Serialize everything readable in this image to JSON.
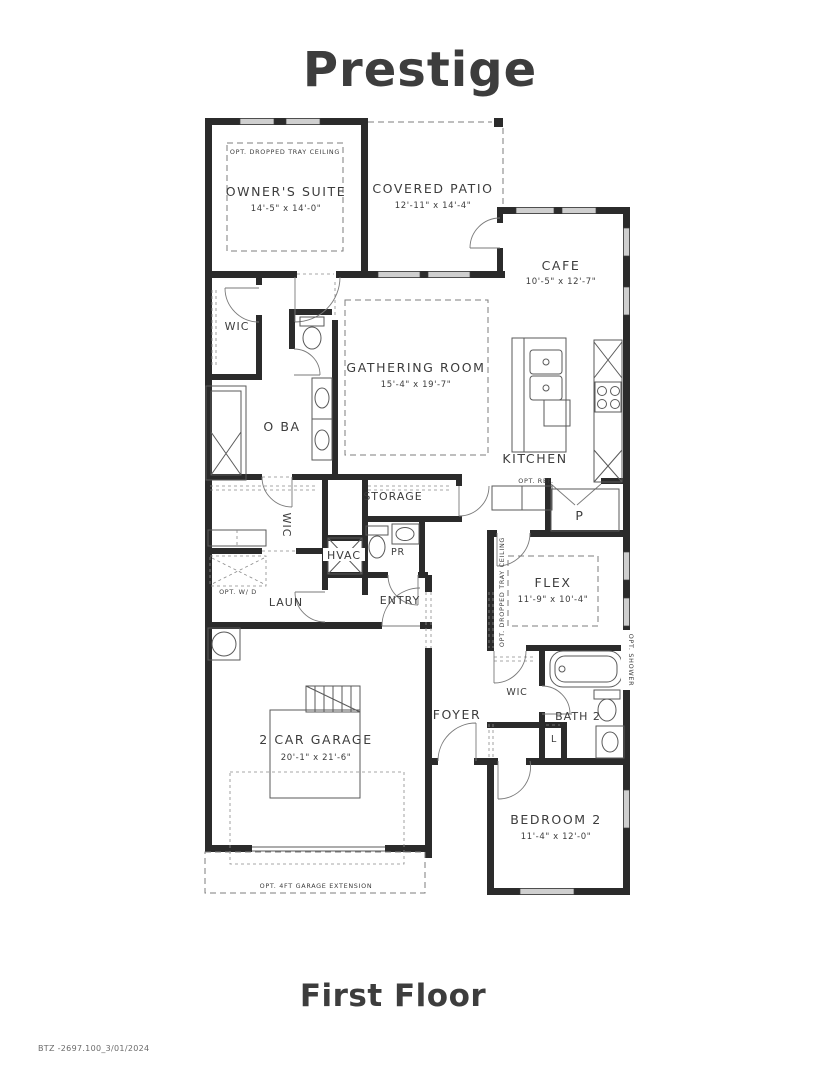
{
  "title": "Prestige",
  "floor_label": "First Floor",
  "doc_code": "BTZ -2697.100_3/01/2024",
  "rooms": {
    "owners_suite": {
      "label": "OWNER'S SUITE",
      "dims": "14'-5\" x 14'-0\""
    },
    "covered_patio": {
      "label": "COVERED PATIO",
      "dims": "12'-11\" x 14'-4\""
    },
    "cafe": {
      "label": "CAFE",
      "dims": "10'-5\" x 12'-7\""
    },
    "gathering_room": {
      "label": "GATHERING ROOM",
      "dims": "15'-4\" x 19'-7\""
    },
    "kitchen": {
      "label": "KITCHEN"
    },
    "owners_wic": {
      "label": "WIC"
    },
    "owners_bath": {
      "label": "O BA"
    },
    "hall_wic": {
      "label": "WIC"
    },
    "storage": {
      "label": "STORAGE"
    },
    "powder": {
      "label": "PR"
    },
    "hvac": {
      "label": "HVAC"
    },
    "laundry": {
      "label": "LAUN"
    },
    "entry": {
      "label": "ENTRY"
    },
    "pantry": {
      "label": "P"
    },
    "flex": {
      "label": "FLEX",
      "dims": "11'-9\" x 10'-4\""
    },
    "foyer": {
      "label": "FOYER"
    },
    "bed2_wic": {
      "label": "WIC"
    },
    "bath2": {
      "label": "BATH 2"
    },
    "linen": {
      "label": "L"
    },
    "bedroom2": {
      "label": "BEDROOM 2",
      "dims": "11'-4\" x 12'-0\""
    },
    "garage": {
      "label": "2 CAR GARAGE",
      "dims": "20'-1\" x 21'-6\""
    }
  },
  "annotations": {
    "tray_owners": "OPT. DROPPED TRAY CEILING",
    "tray_flex": "OPT. DROPPED TRAY CEILING",
    "opt_ref": "OPT. REF.",
    "opt_wd": "OPT. W/ D",
    "opt_shower": "OPT. SHOWER",
    "garage_ext": "OPT. 4FT GARAGE EXTENSION"
  }
}
